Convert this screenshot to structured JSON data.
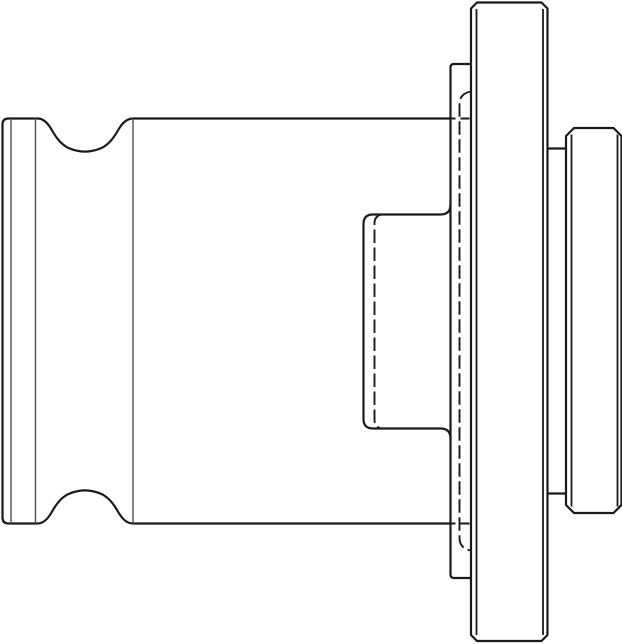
{
  "drawing": {
    "subject": "tap-adapter-side-view-technical-line-drawing",
    "canvas": {
      "width": 622,
      "height": 644
    },
    "style": {
      "background": "#ffffff",
      "line_color": "#1a1a1a",
      "thin_line_color": "#4f4f4f",
      "outline_width": "2.2px",
      "medium_width": "1.8px",
      "thin_width": "1.4px",
      "hidden_width": "1.9px",
      "hidden_dash": "13.5 4.5",
      "hidden_dash_short": "5 5 9 40"
    },
    "paths": {
      "shank_body_profile": "M450.5,118.5 L133,118.5 C127,118.5 122.5,122.5 118.5,129.5 C114.5,136.5 110,143.5 102,147.8 C91,152.8 79,152.8 68,147.8 C60,143.5 55.5,136.5 51.5,129.5 C47.5,122.5 43,118.5 37.5,118.5 L8.5,118.5 Q2.5,118.5 2.5,124.5 L2.5,517.5 Q2.5,523.5 8.5,523.5 L37.5,523.5 C43,523.5 47.5,519.5 51.5,512.5 C55.5,505.5 60,498.5 68,494.2 C79,489.2 91,489.2 102,494.2 C110,498.5 114.5,505.5 118.5,512.5 C122.5,519.5 127,523.5 133,523.5 L450.5,523.5",
      "front_disc": "M471,64 L454,64 Q450.5,64 450.5,67.5 L450.5,574.5 Q450.5,578 454,578 L471,578",
      "drive_boss": "M450.5,204.5 Q450.5,214.5 440.5,214.5 L373,214.5 Q363.5,214.5 363.5,224 L363.5,419 Q363.5,428.5 373,428.5 L440.5,428.5 Q450.5,428.5 450.5,438.5",
      "flange": "M477,2.5 L541.5,2.5 L547.5,8.5 L547.5,635 L541.5,641 L477,641 L471,635 L471,8.5 Z",
      "neck_top": "M547.5,148.5 L566,148.5",
      "neck_bottom": "M547.5,493.5 L566,493.5",
      "knob": "M574,128 L613.5,128 L621.5,136 L621.5,505 L613.5,513 L574,513 L566,505 L566,136 Z",
      "flange_chamfer_left": "M476.5,9 L476.5,635",
      "flange_chamfer_right": "M543,9 L543,635",
      "knob_chamfer_left": "M571.5,134.5 L571.5,506.5",
      "knob_chamfer_right": "M617.5,134.5 L617.5,506.5",
      "shank_tip_edge": "M11,118.5 L11,523.5",
      "groove_edge_line": "M35.5,118.5 L35.5,523.5",
      "body_shoulder_line": "M133,118.5 L133,523.5",
      "boss_bore_hidden": "M381,214.5 Q374.5,216.5 374.5,223 L374.5,420 Q374.5,426.5 381,428.5",
      "flange_bore_hidden": "M471,91.5 Q459.5,93.5 459.5,104 L459.5,538 Q459.5,548.5 471,550.5",
      "body_hidden_top": "M450.5,118.5 L471,118.5",
      "body_hidden_bottom": "M450.5,523.5 L471,523.5"
    }
  }
}
